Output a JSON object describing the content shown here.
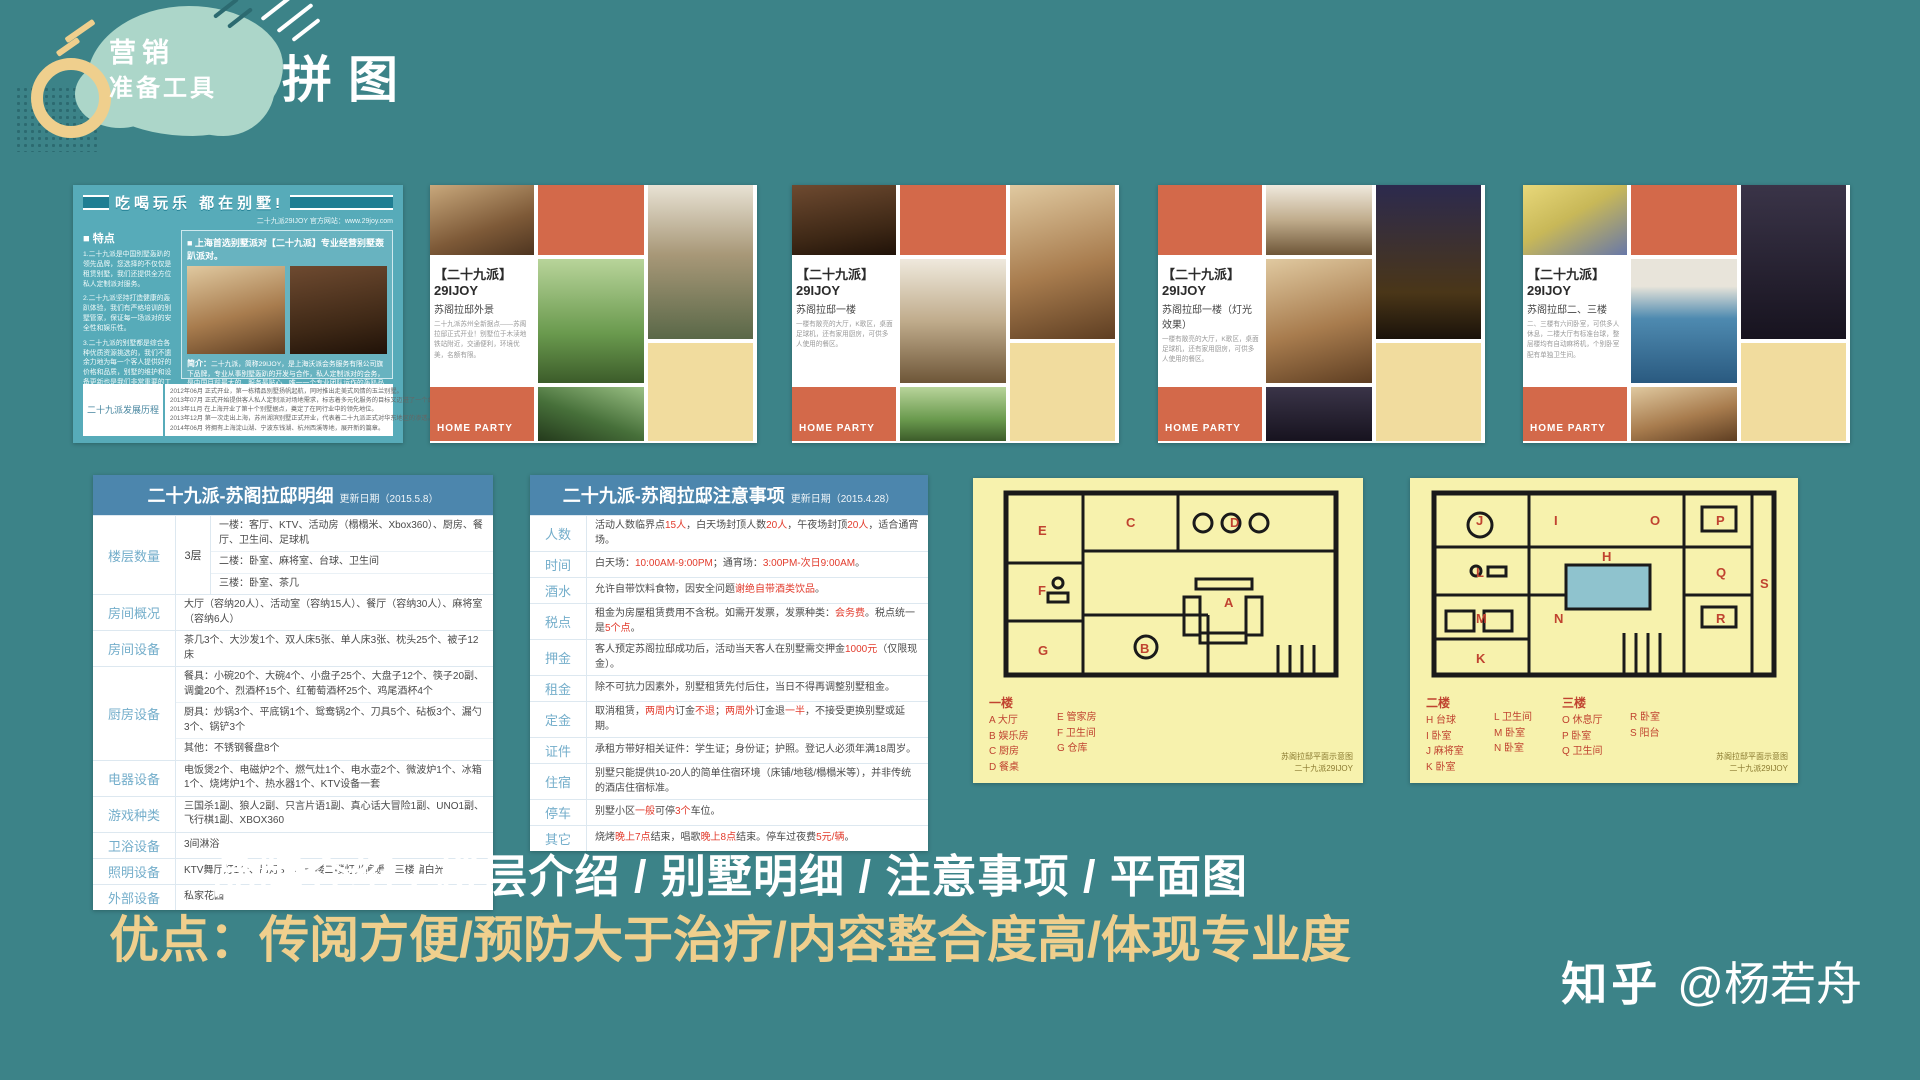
{
  "slide": {
    "badge_line1": "营销",
    "badge_line2": "准备工具",
    "title": "拼图"
  },
  "colors": {
    "background": "#3C8388",
    "mint_blob": "#ACD6C9",
    "accent_yellow": "#EFCF8D",
    "collage_orange": "#D3694A",
    "collage_yellow": "#F1DC9E",
    "table_header_blue": "#4C86AD",
    "row_label_blue": "#74AECB",
    "highlight_red": "#E23B2C",
    "floorplan_yellow": "#F7F2AD",
    "floorplan_letter_red": "#C04330"
  },
  "brochure": {
    "banner": "吃喝玩乐 都在别墅!",
    "site": "二十九派29IJOY 官方网站：www.29joy.com",
    "features_title": "■ 特点",
    "features": [
      "1.二十九派是中国别墅轰趴的领先品牌，您选择的不仅仅是租赁别墅，我们还提供全方位私人定制派对服务。",
      "2.二十九派坚持打造健康的轰趴体验，我们有严格培训的别墅管家，保证每一场派对的安全性和娱乐性。",
      "3.二十九派的别墅都是综合各种优质资源挑选的，我们不遗余力地为每一个客人提供好的价格和品质，别墅的维护和设备更新也是我们非常重要的工作之一。"
    ],
    "headline": "■ 上海首选别墅派对【二十九派】专业经营别墅轰趴派对。",
    "intro_title": "简介：",
    "intro": "二十九派，简称29IJOY，是上海沃派会务服务有限公司旗下品牌，专业从事别墅轰趴的开发与合作，私人定制派对的会务，是中国目前最大的、服务最贴心、唯一一个专业团队运作的轰趴品牌缔造者。",
    "history_label": "二十九派发展历程",
    "history": [
      "2012年06月  正式开业，第一栋精品别墅扬帆起航，同时推出走美式风情的玉兰别墅。",
      "2013年07月  正式开始提供客人私人定制派对场地需求，标志着多元化服务的目标又迈进了一个台阶。",
      "2013年11月  在上海开业了第十个别墅据点，奠定了在同行业中的领先地位。",
      "2013年12月  第一次走出上海，苏州湖滨别墅正式开业，代表着二十九派正式对华东地区的渗透。",
      "2014年06月  将拥有上海淀山湖、宁波东钱湖、杭州西溪等地，展开新的篇章。"
    ]
  },
  "flyers": [
    {
      "brand": "【二十九派】29IJOY",
      "subtitle": "苏阁拉邸外景",
      "desc": "二十九派苏州全新据点——苏阁拉邸正式开业！别墅位于木渎地铁站附近，交通便利，环境优美，名额有限。",
      "footer": "HOME PARTY"
    },
    {
      "brand": "【二十九派】29IJOY",
      "subtitle": "苏阁拉邸一楼",
      "desc": "一楼有敞亮的大厅，K歌区，桌面足球机，还有家用厨房，可供多人使用的餐区。",
      "footer": "HOME PARTY"
    },
    {
      "brand": "【二十九派】29IJOY",
      "subtitle": "苏阁拉邸一楼（灯光效果）",
      "desc": "一楼有敞亮的大厅，K歌区，桌面足球机，还有家用厨房，可供多人使用的餐区。",
      "footer": "HOME PARTY"
    },
    {
      "brand": "【二十九派】29IJOY",
      "subtitle": "苏阁拉邸二、三楼",
      "desc": "二、三楼有六间卧室，可供多人休息，二楼大厅有标准台球，整层楼均有自动麻将机，个别卧室配有单独卫生间。",
      "footer": "HOME PARTY"
    }
  ],
  "table1": {
    "title": "二十九派-苏阁拉邸明细",
    "date": "更新日期（2015.5.8）",
    "rows": [
      {
        "label": "楼层数量",
        "extra": "3层",
        "lines": [
          "一楼：客厅、KTV、活动房（榻榻米、Xbox360）、厨房、餐厅、卫生间、足球机",
          "二楼：卧室、麻将室、台球、卫生间",
          "三楼：卧室、茶几"
        ]
      },
      {
        "label": "房间概况",
        "lines": [
          "大厅（容纳20人）、活动室（容纳15人）、餐厅（容纳30人）、麻将室（容纳6人）"
        ]
      },
      {
        "label": "房间设备",
        "lines": [
          "茶几3个、大沙发1个、双人床5张、单人床3张、枕头25个、被子12床"
        ]
      },
      {
        "label": "厨房设备",
        "lines": [
          "餐具：小碗20个、大碗4个、小盘子25个、大盘子12个、筷子20副、调羹20个、烈酒杯15个、红葡萄酒杯25个、鸡尾酒杯4个",
          "厨具：炒锅3个、平底锅1个、鸳鸯锅2个、刀具5个、砧板3个、漏勺3个、锅铲3个",
          "其他：不锈钢餐盘8个"
        ]
      },
      {
        "label": "电器设备",
        "lines": [
          "电饭煲2个、电磁炉2个、燃气灶1个、电水壶2个、微波炉1个、冰箱1个、烧烤炉1个、热水器1个、KTV设备一套"
        ]
      },
      {
        "label": "游戏种类",
        "lines": [
          "三国杀1副、狼人2副、只言片语1副、真心话大冒险1副、UNO1副、飞行棋1副、XBOX360"
        ]
      },
      {
        "label": "卫浴设备",
        "lines": [
          "3间淋浴"
        ]
      },
      {
        "label": "照明设备",
        "lines": [
          "KTV舞厅灯1个、吊灯3个、一楼二楼灯光偏暖、三楼偏白光"
        ]
      },
      {
        "label": "外部设备",
        "lines": [
          "私家花园"
        ]
      }
    ]
  },
  "table2": {
    "title": "二十九派-苏阁拉邸注意事项",
    "date": "更新日期（2015.4.28）",
    "rows": [
      {
        "label": "人数",
        "parts": [
          [
            "活动人数临界点",
            0
          ],
          [
            "15人",
            1
          ],
          [
            "，白天场封顶人数",
            0
          ],
          [
            "20人",
            1
          ],
          [
            "，午夜场封顶",
            0
          ],
          [
            "20人",
            1
          ],
          [
            "，适合通宵场。",
            0
          ]
        ]
      },
      {
        "label": "时间",
        "parts": [
          [
            "白天场：",
            0
          ],
          [
            "10:00AM-9:00PM",
            1
          ],
          [
            "；通宵场：",
            0
          ],
          [
            "3:00PM-次日9:00AM",
            1
          ],
          [
            "。",
            0
          ]
        ]
      },
      {
        "label": "酒水",
        "parts": [
          [
            "允许自带饮料食物，因安全问题",
            0
          ],
          [
            "谢绝自带酒类饮品",
            1
          ],
          [
            "。",
            0
          ]
        ]
      },
      {
        "label": "税点",
        "parts": [
          [
            "租金为房屋租赁费用不含税。如需开发票，发票种类：",
            0
          ],
          [
            "会务费",
            1
          ],
          [
            "。税点统一是",
            0
          ],
          [
            "5个点",
            1
          ],
          [
            "。",
            0
          ]
        ]
      },
      {
        "label": "押金",
        "parts": [
          [
            "客人预定苏阁拉邸成功后，活动当天客人在别墅需交押金",
            0
          ],
          [
            "1000元",
            1
          ],
          [
            "（仅限现金）。",
            0
          ]
        ]
      },
      {
        "label": "租金",
        "parts": [
          [
            "除不可抗力因素外，别墅租赁先付后住，当日不得再调整别墅租金。",
            0
          ]
        ]
      },
      {
        "label": "定金",
        "parts": [
          [
            "取消租赁，",
            0
          ],
          [
            "两周内",
            1
          ],
          [
            "订金",
            0
          ],
          [
            "不退",
            1
          ],
          [
            "；",
            0
          ],
          [
            "两周外",
            1
          ],
          [
            "订金退",
            0
          ],
          [
            "一半",
            1
          ],
          [
            "，不接受更换别墅或延期。",
            0
          ]
        ]
      },
      {
        "label": "证件",
        "parts": [
          [
            "承租方带好相关证件：学生证；身份证；护照。登记人必须年满18周岁。",
            0
          ]
        ]
      },
      {
        "label": "住宿",
        "parts": [
          [
            "别墅只能提供10-20人的简单住宿环境（床铺/地毯/榻榻米等），并非传统的酒店住宿标准。",
            0
          ]
        ]
      },
      {
        "label": "停车",
        "parts": [
          [
            "别墅小区",
            0
          ],
          [
            "一般",
            1
          ],
          [
            "可停",
            0
          ],
          [
            "3个",
            1
          ],
          [
            "车位。",
            0
          ]
        ]
      },
      {
        "label": "其它",
        "parts": [
          [
            "烧烤",
            0
          ],
          [
            "晚上7点",
            1
          ],
          [
            "结束，唱歌",
            0
          ],
          [
            "晚上8点",
            1
          ],
          [
            "结束。停车过夜费",
            0
          ],
          [
            "5元/辆",
            1
          ],
          [
            "。",
            0
          ]
        ]
      }
    ]
  },
  "floorplan1": {
    "legend": [
      {
        "title": "一楼",
        "items": [
          [
            "A",
            "大厅"
          ],
          [
            "B",
            "娱乐房"
          ],
          [
            "C",
            "厨房"
          ],
          [
            "D",
            "餐桌"
          ]
        ]
      },
      {
        "title": "",
        "items": [
          [
            "E",
            "管家房"
          ],
          [
            "F",
            "卫生间"
          ],
          [
            "G",
            "仓库"
          ]
        ]
      }
    ],
    "rooms": [
      {
        "l": "A",
        "x": 246,
        "y": 124
      },
      {
        "l": "B",
        "x": 162,
        "y": 170
      },
      {
        "l": "C",
        "x": 148,
        "y": 44
      },
      {
        "l": "D",
        "x": 252,
        "y": 44
      },
      {
        "l": "E",
        "x": 60,
        "y": 52
      },
      {
        "l": "F",
        "x": 60,
        "y": 112
      },
      {
        "l": "G",
        "x": 60,
        "y": 172
      }
    ],
    "caption_line1": "苏阁拉邸平面示意图",
    "caption_line2": "二十九派29IJOY"
  },
  "floorplan2": {
    "legend": [
      {
        "title": "二楼",
        "items": [
          [
            "H",
            "台球"
          ],
          [
            "I",
            "卧室"
          ],
          [
            "J",
            "麻将室"
          ],
          [
            "K",
            "卧室"
          ]
        ]
      },
      {
        "title": "",
        "items": [
          [
            "L",
            "卫生间"
          ],
          [
            "M",
            "卧室"
          ],
          [
            "N",
            "卧室"
          ]
        ]
      },
      {
        "title": "三楼",
        "items": [
          [
            "O",
            "休息厅"
          ],
          [
            "P",
            "卧室"
          ],
          [
            "Q",
            "卫生间"
          ]
        ]
      },
      {
        "title": "",
        "items": [
          [
            "R",
            "卧室"
          ],
          [
            "S",
            "阳台"
          ]
        ]
      }
    ],
    "rooms": [
      {
        "l": "H",
        "x": 188,
        "y": 78
      },
      {
        "l": "I",
        "x": 140,
        "y": 42
      },
      {
        "l": "J",
        "x": 62,
        "y": 42
      },
      {
        "l": "K",
        "x": 62,
        "y": 180
      },
      {
        "l": "L",
        "x": 62,
        "y": 94
      },
      {
        "l": "M",
        "x": 62,
        "y": 140
      },
      {
        "l": "N",
        "x": 140,
        "y": 140
      },
      {
        "l": "O",
        "x": 236,
        "y": 42
      },
      {
        "l": "P",
        "x": 302,
        "y": 42
      },
      {
        "l": "Q",
        "x": 302,
        "y": 94
      },
      {
        "l": "R",
        "x": 302,
        "y": 140
      },
      {
        "l": "S",
        "x": 346,
        "y": 105
      }
    ],
    "caption_line1": "苏阁拉邸平面示意图",
    "caption_line2": "二十九派29IJOY"
  },
  "footer": {
    "line1": "品牌介绍 / 楼层介绍 / 别墅明细 / 注意事项 / 平面图",
    "line2": "优点：传阅方便/预防大于治疗/内容整合度高/体现专业度",
    "watermark_brand": "知乎",
    "watermark_handle": "@杨若舟"
  }
}
